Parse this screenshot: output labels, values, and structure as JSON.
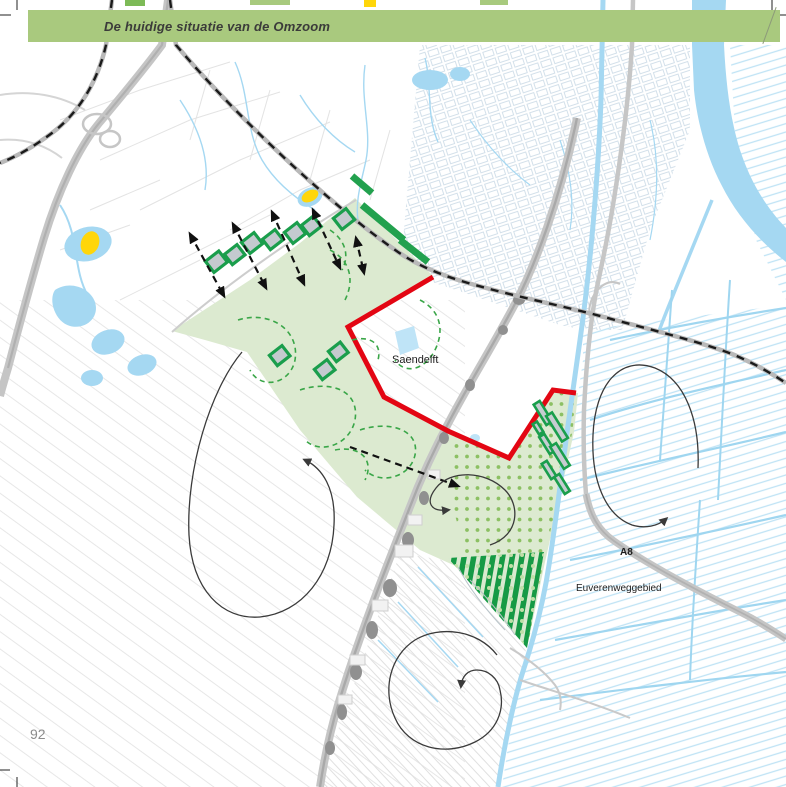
{
  "page": {
    "title": "De huidige situatie van de Omzoom",
    "page_number": "92"
  },
  "map": {
    "labels": {
      "saendelft": "Saendelft",
      "a8": "A8",
      "euverenweggebied": "Euverenweggebied"
    },
    "features": [
      "omzoom-green-area",
      "saendelft-red-boundary",
      "railway-dashed-lines",
      "highway-a8",
      "polder-ditches",
      "farm-plots-with-arrows",
      "greenhouse-strips",
      "dotted-recreation-area",
      "circulation-swirl-arrows",
      "yellow-highlight-ponds"
    ],
    "colors": {
      "banner_green": "#a9c97e",
      "area_green": "#dcead0",
      "dark_green": "#189e4a",
      "boundary_red": "#e30613",
      "water_blue": "#a5d8f2",
      "road_gray": "#c5c5c5",
      "rail_black": "#1a1a1a",
      "highlight_yellow": "#ffd60a",
      "page_number_gray": "#8c8c8c"
    }
  }
}
